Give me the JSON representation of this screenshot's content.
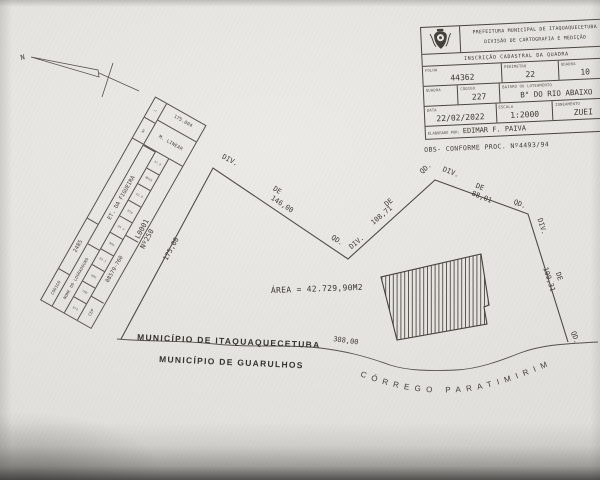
{
  "colors": {
    "paper": "#e7e5e1",
    "ink": "#3b3831",
    "line": "#4e4b44"
  },
  "scan": {
    "north_label": "N",
    "title_block": {
      "org_line1": "PREFEITURA MUNICIPAL DE ITAQUAQUECETUBA",
      "org_line2": "DIVISÃO DE CARTOGRAFIA E MEDIÇÃO",
      "section_title": "INSCRIÇÃO CADASTRAL DA QUADRA",
      "folha_label": "FOLHA",
      "folha_value": "44362",
      "perimetro_label": "PERÍMETRO",
      "perimetro_value": "22",
      "quadra_label": "QUADRA",
      "quadra_value": "10",
      "quadra2_label": "QUADRA",
      "quadra2_value": "",
      "codigo_label": "CÓDIGO",
      "codigo_value": "227",
      "bairro_label": "BAIRRO OU LOTEAMENTO",
      "bairro_value": "B° DO RIO ABAIXO",
      "data_label": "DATA",
      "data_value": "22/02/2022",
      "escala_label": "ESCALA",
      "escala_value": "1:2000",
      "zoneamento_label": "ZONEAMENTO",
      "zoneamento_value": "ZUEI",
      "elaborado_label": "ELABORADO POR:",
      "elaborado_value": "EDIMAR F. PAIVA",
      "obs": "OBS- CONFORME PROC. Nº4493/94"
    },
    "street_table": {
      "codigo_label": "CÓDIGO",
      "codigo_value": "2485",
      "nome_label": "NOME DO LOGRADOURO",
      "nome_value": "ET. DA FIGUEIRA",
      "cep_label": "CEP",
      "cep_value": "08579-760",
      "header_n": "Nº",
      "header_l": "L",
      "linear_label": "M. LINEAR",
      "linear_value": "175.004",
      "lot_cells": [
        "Nº4",
        "7M0",
        "6M6",
        "04.1",
        "0M6",
        "04 a",
        "M7W",
        "42.9",
        "NM19",
        "47.9"
      ]
    },
    "plan": {
      "area_text": "ÁREA = 42.729,90M2",
      "div": "DIV.",
      "qd": "QD.",
      "de": "DE",
      "dim_146": "146,00",
      "dim_108": "108,71",
      "dim_88": "88,01",
      "dim_109": "109,31",
      "dim_175": "175,00",
      "dim_388": "388,00",
      "lot_code": "L0001",
      "lot_number": "Nº250",
      "municipality_top": "MUNICÍPIO DE ITAQUAQUECETUBA",
      "municipality_bottom": "MUNICÍPIO DE GUARULHOS",
      "stream_name": "CÓRREGO PARATIMIRIM"
    }
  }
}
